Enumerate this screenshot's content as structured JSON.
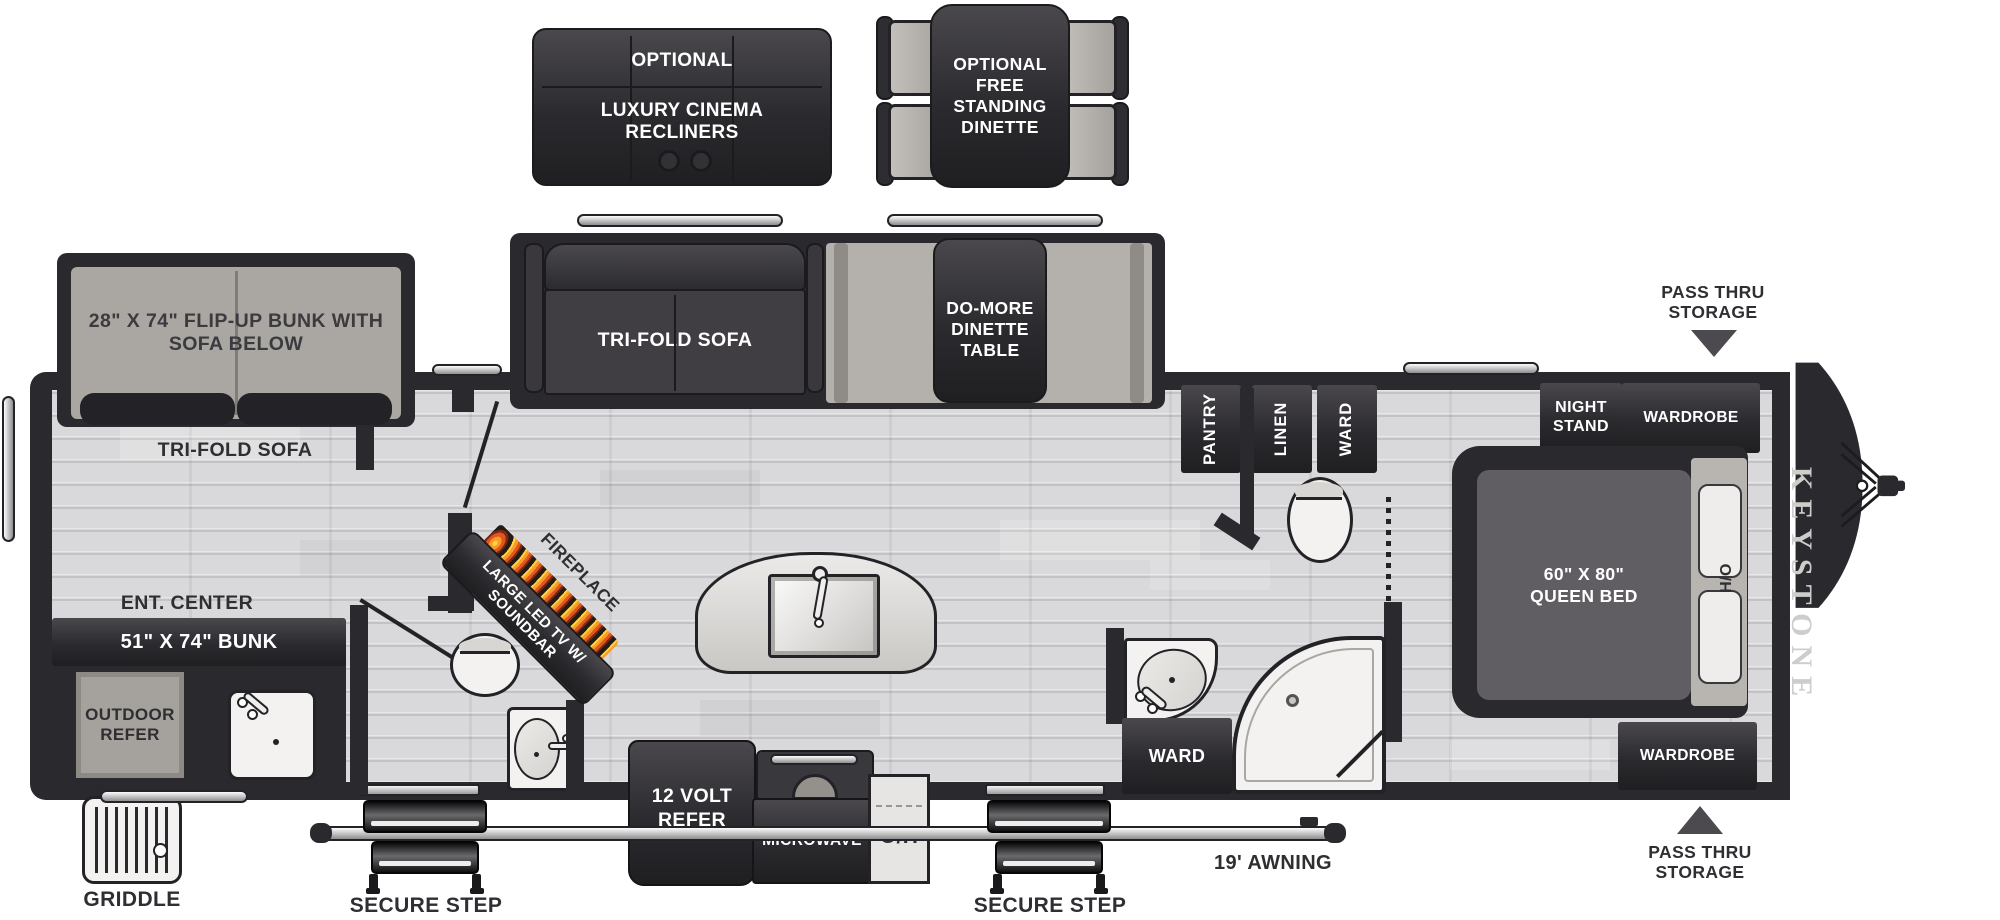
{
  "title": "Keystone travel trailer floorplan",
  "labels": {
    "optional_tag": "OPTIONAL",
    "luxury_recliners": "LUXURY CINEMA RECLINERS",
    "free_standing_dinette": "OPTIONAL FREE STANDING DINETTE",
    "flip_up_bunk": "28\" X 74\" FLIP-UP BUNK WITH SOFA BELOW",
    "tri_fold_sofa_rear": "TRI-FOLD SOFA",
    "tri_fold_sofa_slide": "TRI-FOLD SOFA",
    "do_more_dinette_table": "DO-MORE DINETTE TABLE",
    "pantry": "PANTRY",
    "linen": "LINEN",
    "ward_upper": "WARD",
    "ward_lower": "WARD",
    "night_stand": "NIGHT STAND",
    "wardrobe_front": "WARDROBE",
    "wardrobe_rear": "WARDROBE",
    "queen_bed": "60\" X 80\" QUEEN BED",
    "head_of_bed": "H/O",
    "pass_thru_top": "PASS THRU STORAGE",
    "pass_thru_bottom": "PASS THRU STORAGE",
    "keystone_logo": "KEYSTONE",
    "ent_center": "ENT. CENTER",
    "bunk_51x74": "51\" X 74\" BUNK",
    "outdoor_refer": "OUTDOOR REFER",
    "griddle": "GRIDDLE",
    "fireplace": "FIREPLACE",
    "led_tv": "LARGE LED TV W/ SOUNDBAR",
    "refer_12v": "12 VOLT REFER",
    "microwave": "MICROWAVE",
    "overhead": "O/H",
    "secure_step_left": "SECURE STEP",
    "secure_step_right": "SECURE STEP",
    "awning": "19' AWNING"
  },
  "colors": {
    "wall": "#2a292d",
    "furniture_dark": "#3a383c",
    "floor": "#d9d9db",
    "fixture_white": "#f3f2f0",
    "flame_orange": "#f0761f",
    "metal": "#c9c9cb"
  }
}
